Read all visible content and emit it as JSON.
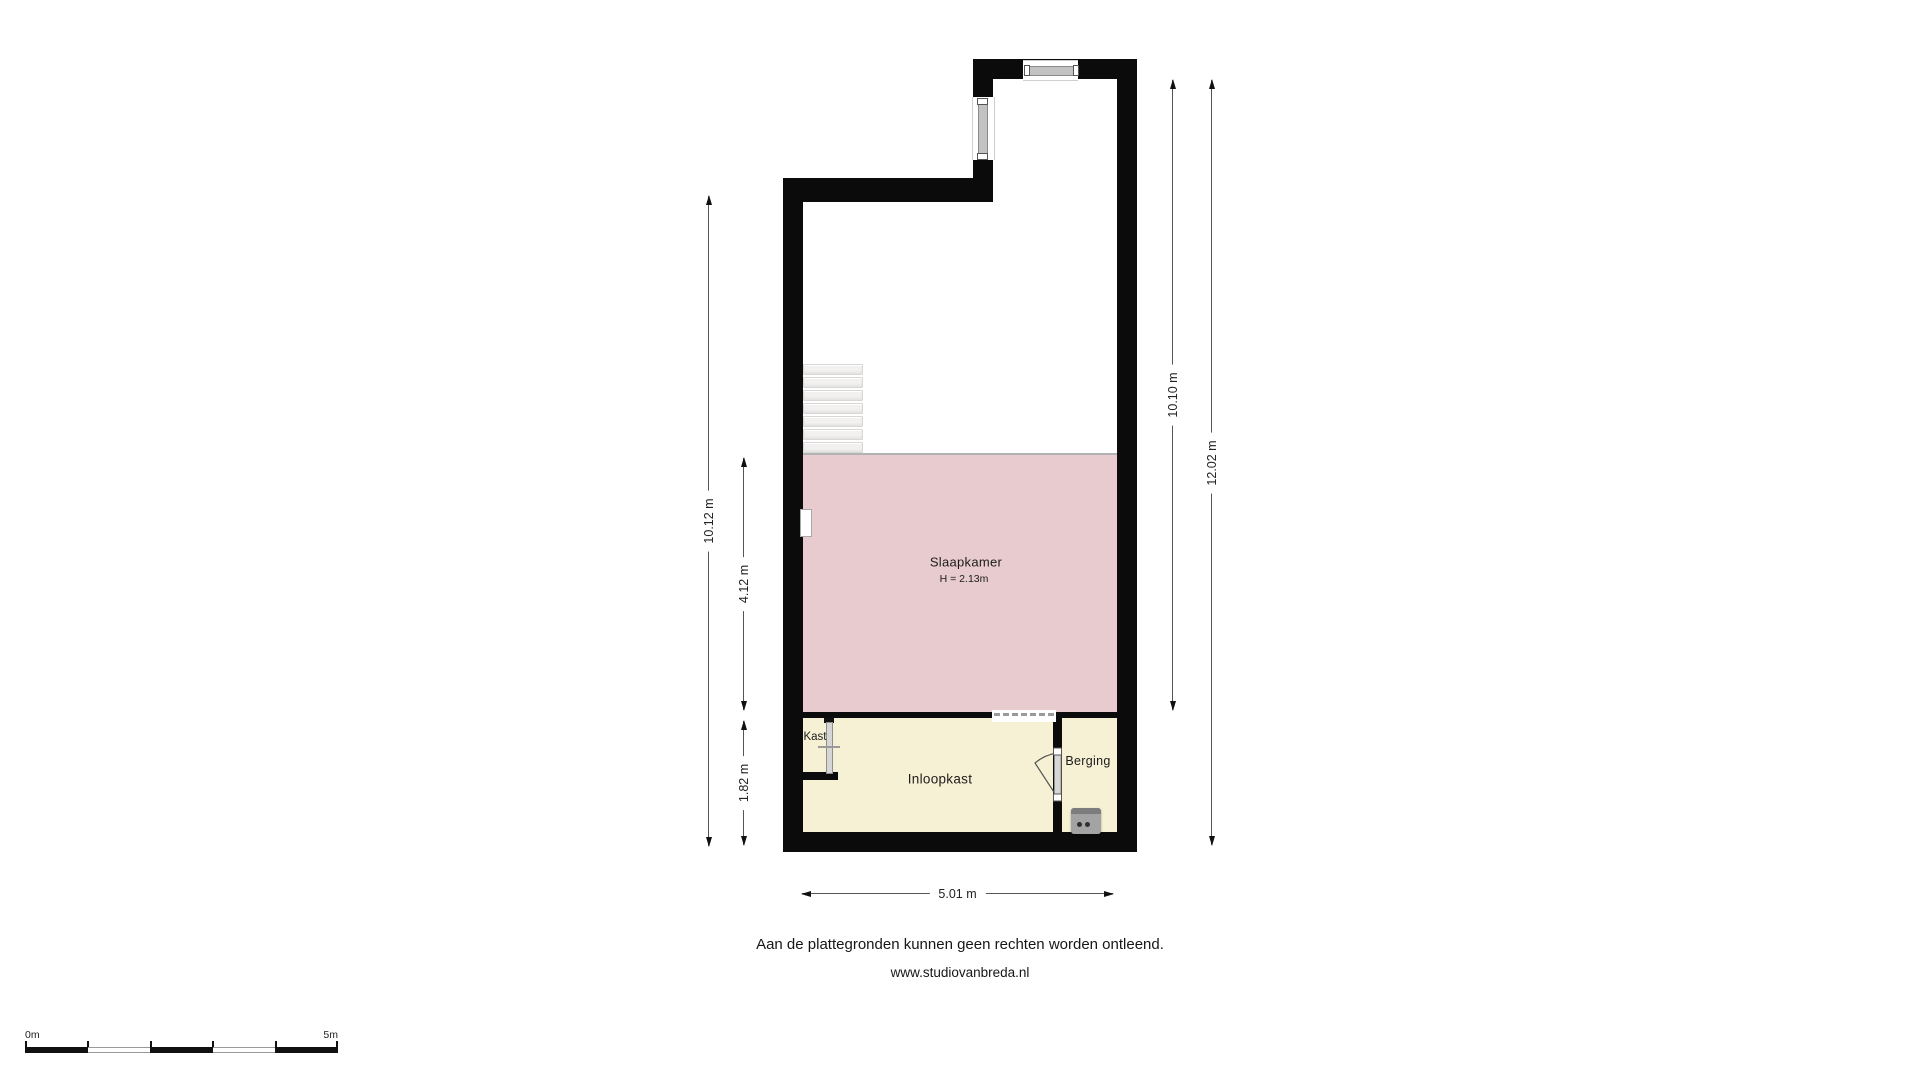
{
  "floorplan": {
    "rooms": {
      "slaapkamer": {
        "label": "Slaapkamer",
        "height": "H = 2.13m"
      },
      "kast": {
        "label": "Kast"
      },
      "inloopkast": {
        "label": "Inloopkast"
      },
      "berging": {
        "label": "Berging"
      }
    },
    "dimensions": {
      "left_total": "10.12 m",
      "slaapkamer_height": "4.12 m",
      "bottom_section_height": "1.82 m",
      "right_upper": "10.10 m",
      "right_total": "12.02 m",
      "width": "5.01 m"
    },
    "colors": {
      "wall": "#0b0b0b",
      "slaapkamer_fill": "#e8cbce",
      "closet_fill": "#f6f1d4",
      "stairs_fill": "#f2f1f0",
      "door_leaf": "#d6d6d6",
      "appliance": "#a3a3a3",
      "dimension_line": "#555555"
    }
  },
  "footer": {
    "disclaimer": "Aan de plattegronden kunnen geen rechten worden ontleend.",
    "website": "www.studiovanbreda.nl"
  },
  "scale_bar": {
    "start": "0m",
    "end": "5m"
  }
}
